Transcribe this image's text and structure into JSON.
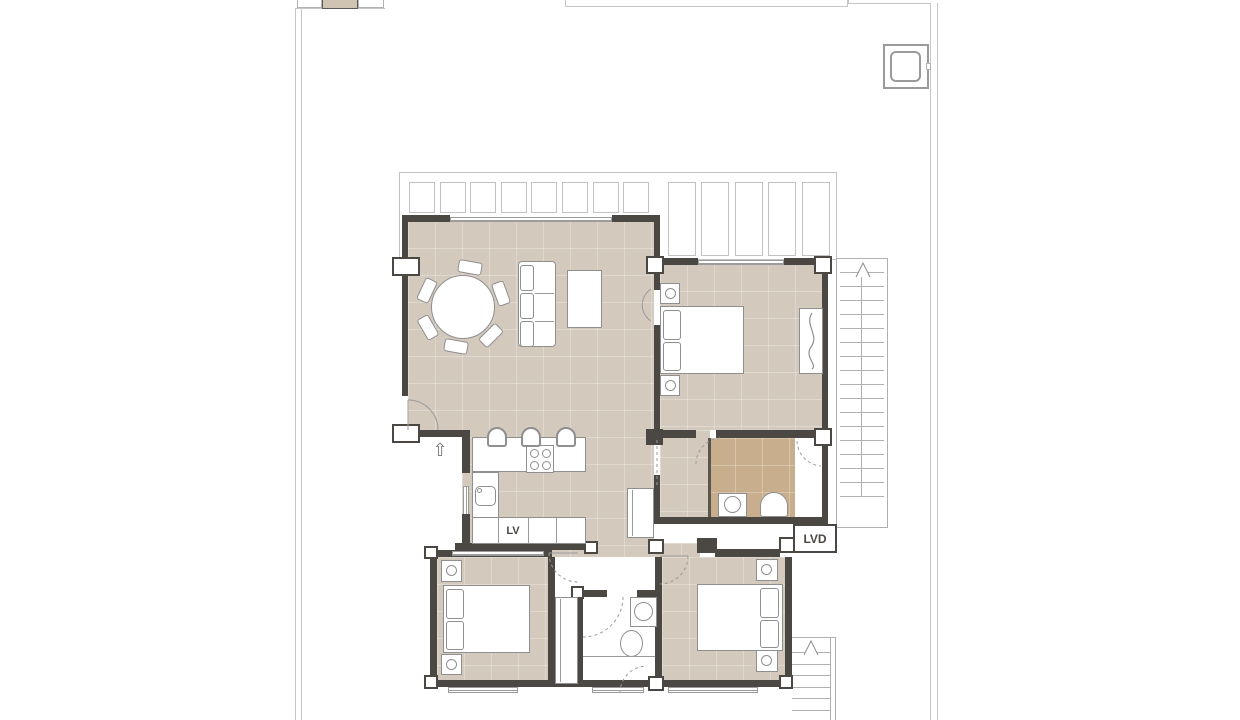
{
  "plan": {
    "labels": {
      "lv": "LV",
      "lvd": "LVD"
    },
    "symbols": {
      "entry_arrow": "⇧"
    },
    "colors": {
      "background": "#ffffff",
      "floor_beige": "#d3c9bc",
      "floor_tan": "#c9ae8e",
      "wall": "#4b4742",
      "boundary_line": "#c6c6c6",
      "thin_line": "#9b9b9b",
      "furniture_outline": "#8f8f8f"
    }
  }
}
